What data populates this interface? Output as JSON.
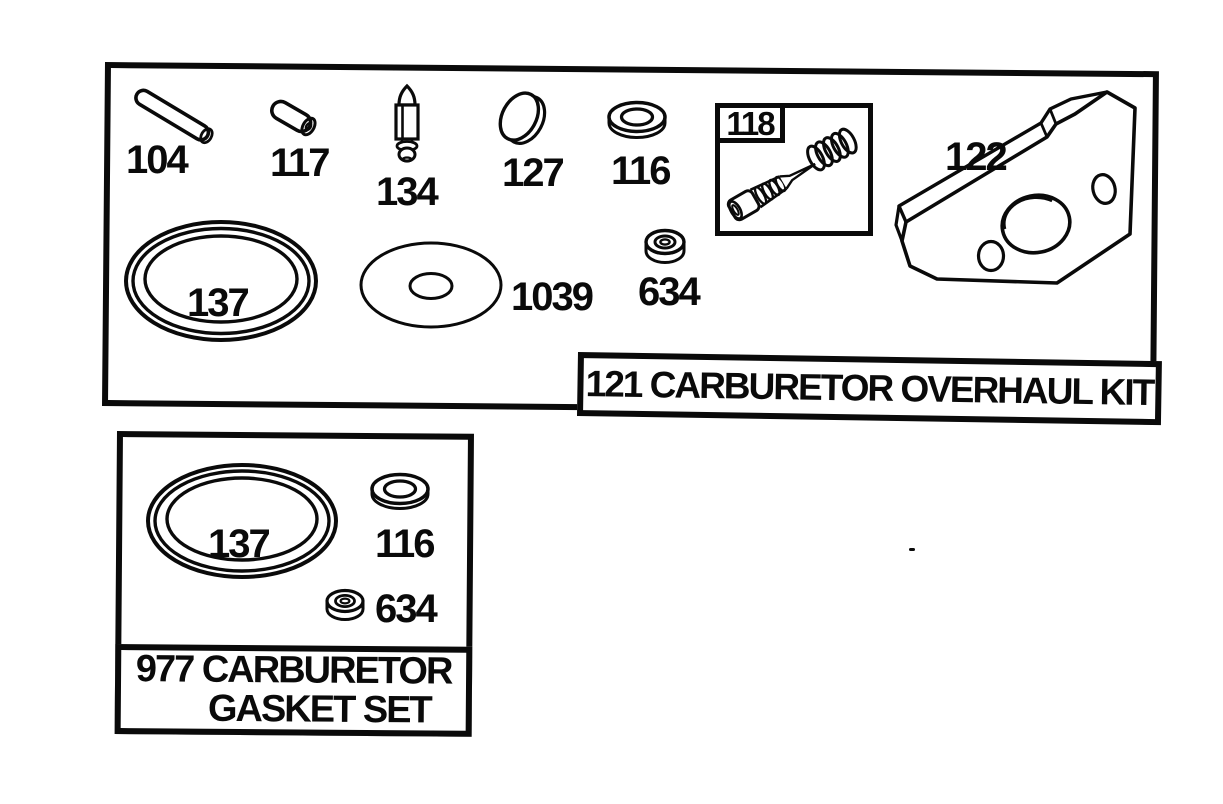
{
  "kit121": {
    "title": "121 CARBURETOR OVERHAUL KIT",
    "parts": {
      "p104": "104",
      "p117": "117",
      "p134": "134",
      "p127": "127",
      "p116": "116",
      "p118": "118",
      "p122": "122",
      "p137": "137",
      "p1039": "1039",
      "p634": "634"
    }
  },
  "set977": {
    "title_line1": "977 CARBURETOR",
    "title_line2": "GASKET SET",
    "parts": {
      "p137": "137",
      "p116": "116",
      "p634": "634"
    }
  },
  "colors": {
    "ink": "#0a0a0a",
    "paper": "#ffffff"
  }
}
